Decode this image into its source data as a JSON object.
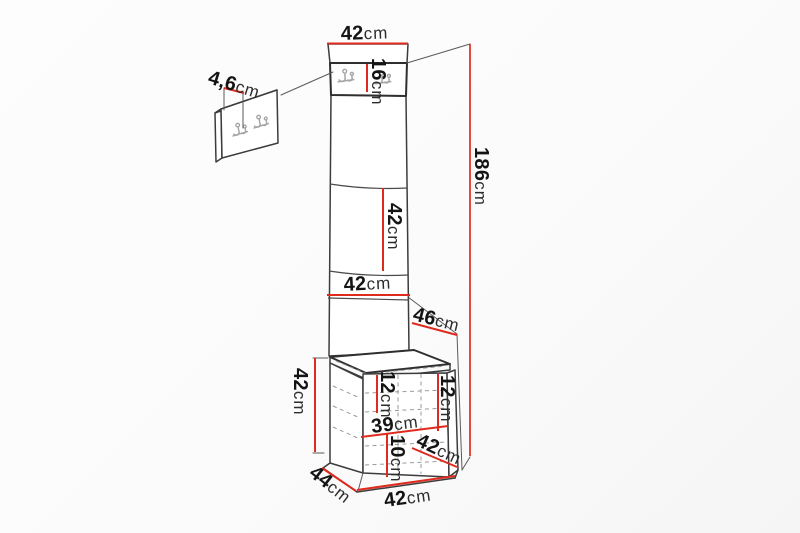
{
  "dimensions": {
    "panel_top_width": {
      "value": "42",
      "unit": "cm"
    },
    "hook_panel_height": {
      "value": "16",
      "unit": "cm"
    },
    "panel_section_height": {
      "value": "42",
      "unit": "cm"
    },
    "panel_width": {
      "value": "42",
      "unit": "cm"
    },
    "total_height": {
      "value": "186",
      "unit": "cm"
    },
    "seat_depth": {
      "value": "46",
      "unit": "cm"
    },
    "bench_height": {
      "value": "42",
      "unit": "cm"
    },
    "bench_inner_left_height": {
      "value": "12",
      "unit": "cm"
    },
    "bench_inner_right_height": {
      "value": "12",
      "unit": "cm"
    },
    "bench_inner_width": {
      "value": "39",
      "unit": "cm"
    },
    "bench_plinth_height": {
      "value": "10",
      "unit": "cm"
    },
    "bench_inner_depth": {
      "value": "42",
      "unit": "cm"
    },
    "bench_depth": {
      "value": "44",
      "unit": "cm"
    },
    "bench_width": {
      "value": "42",
      "unit": "cm"
    },
    "hook_plate_thickness": {
      "value": "4,6",
      "unit": "cm"
    }
  },
  "colors": {
    "dimension_line": "#df2b1e",
    "outline": "#3c3c3c",
    "hook_metal": "#a5a5a5",
    "background": "#fbfbfb",
    "label_text": "#141414"
  }
}
